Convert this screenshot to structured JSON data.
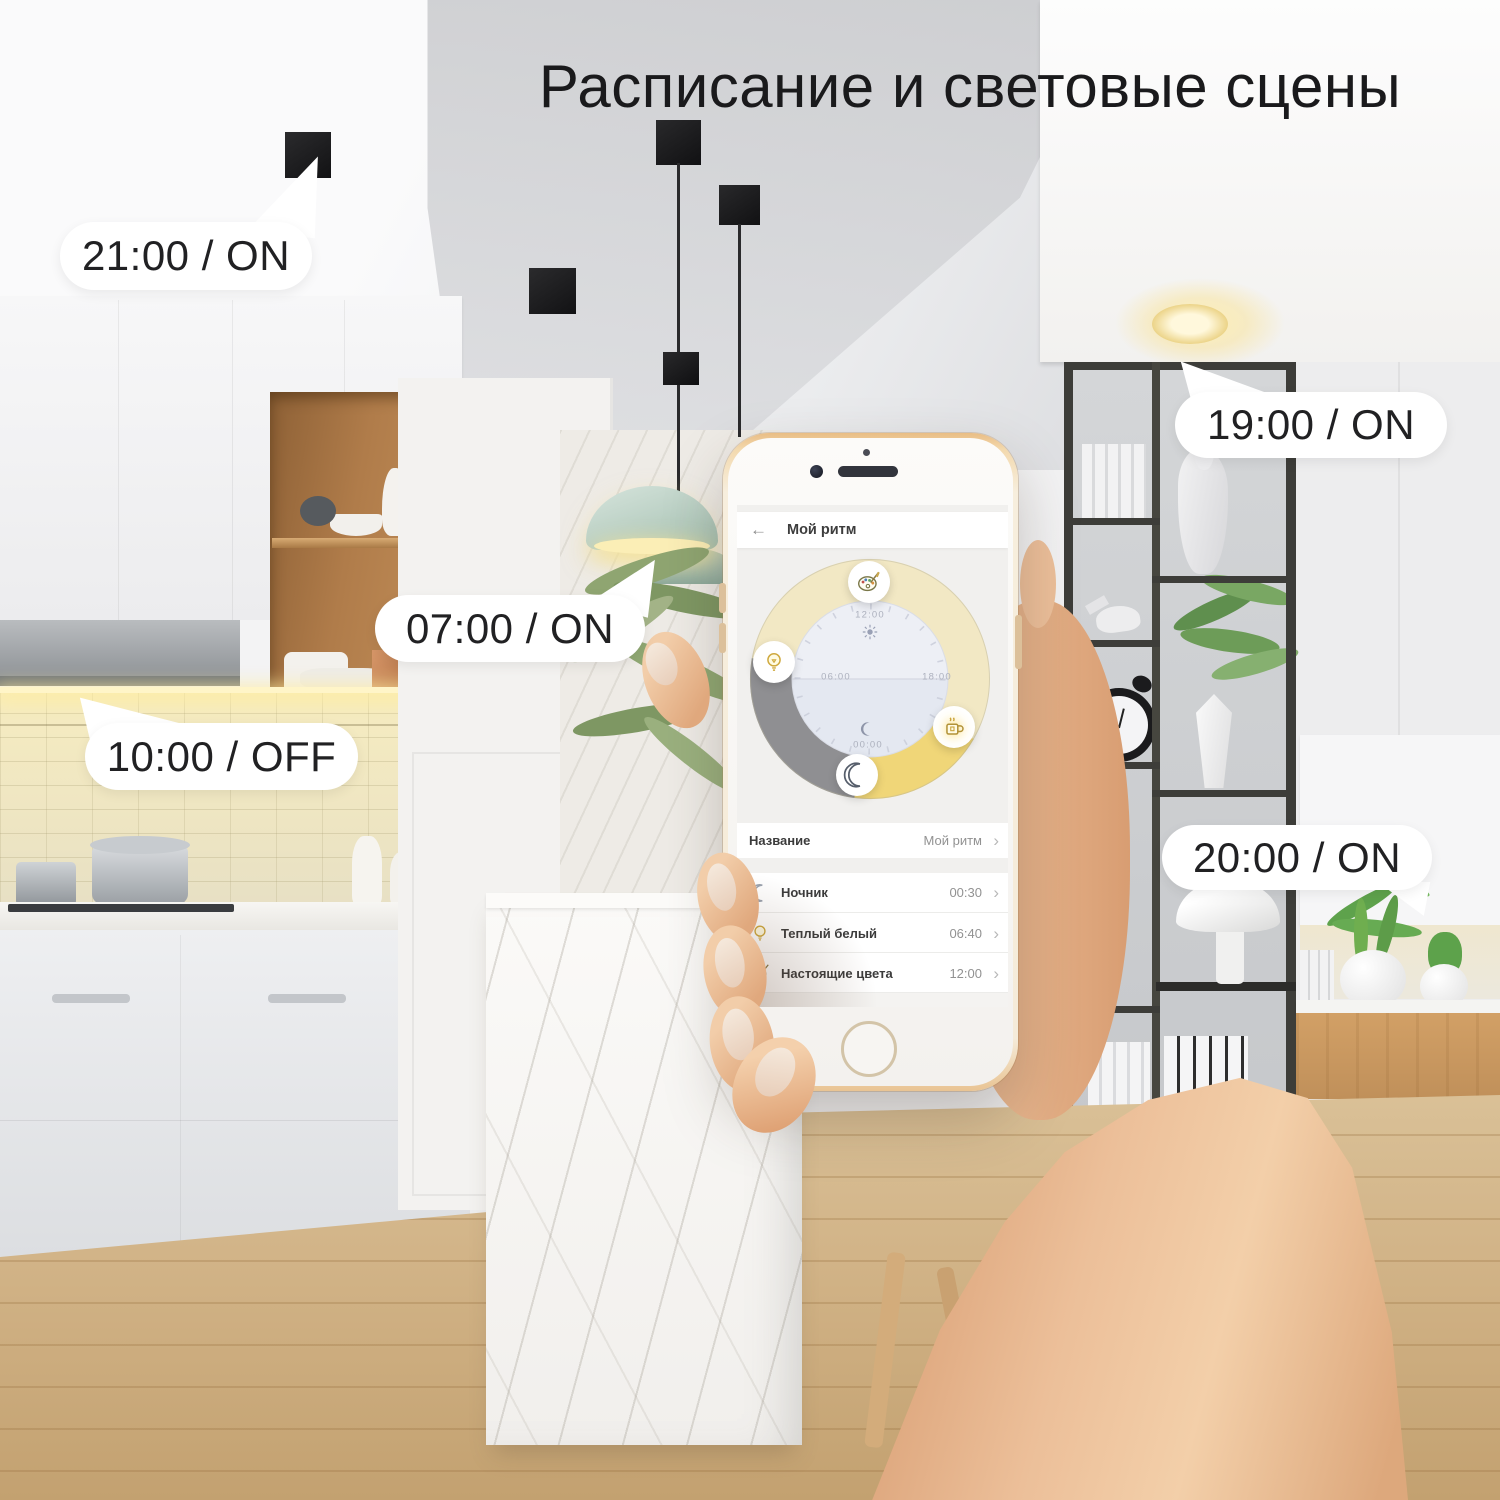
{
  "banner": {
    "title": "Расписание и световые сцены"
  },
  "callouts": [
    {
      "text": "21:00 / ON"
    },
    {
      "text": "07:00 / ON"
    },
    {
      "text": "10:00 / OFF"
    },
    {
      "text": "19:00 / ON"
    },
    {
      "text": "20:00 / ON"
    }
  ],
  "phone_app": {
    "header": {
      "back_icon": "←",
      "title": "Мой ритм"
    },
    "clock": {
      "labels": {
        "top": "12:00",
        "left": "06:00",
        "right": "18:00",
        "bottom": "00:00"
      },
      "segments": [
        {
          "name": "day",
          "color": "#f2e8c4",
          "from": "06:40",
          "to": "20:00"
        },
        {
          "name": "evening",
          "color": "#f0d678",
          "from": "20:00",
          "to": "00:30"
        },
        {
          "name": "night",
          "color": "#8f8f92",
          "from": "00:30",
          "to": "06:40"
        }
      ],
      "badges": [
        {
          "icon": "palette-icon",
          "time": "12:00"
        },
        {
          "icon": "bulb-icon",
          "time": "06:40"
        },
        {
          "icon": "coffee-icon",
          "time": "20:00"
        },
        {
          "icon": "moon-icon",
          "time": "00:30"
        }
      ]
    },
    "name_row": {
      "label": "Название",
      "value": "Мой ритм"
    },
    "scenes": [
      {
        "icon": "moon-icon",
        "label": "Ночник",
        "time": "00:30"
      },
      {
        "icon": "bulb-icon",
        "label": "Теплый белый",
        "time": "06:40"
      },
      {
        "icon": "palette-icon",
        "label": "Настоящие цвета",
        "time": "12:00"
      }
    ],
    "ui": {
      "chevron": "›"
    }
  },
  "colors": {
    "ring_day": "#f2e8c4",
    "ring_evening": "#f0d678",
    "ring_night": "#8f8f92",
    "clock_face_top": "#edeff5",
    "clock_face_bottom": "#e4e8f1",
    "bubble_bg": "#ffffff",
    "text_dark": "#1a1a1c",
    "accent_warm": "#f5e27a",
    "phone_gold": "#e9bd85"
  }
}
